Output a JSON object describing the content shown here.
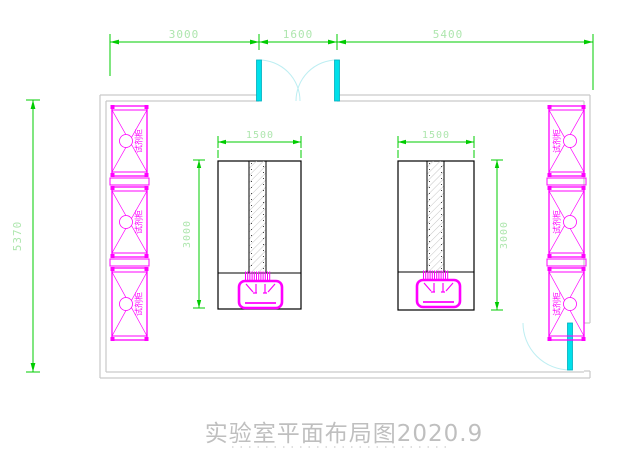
{
  "title": {
    "text": "实验室平面布局图2020.9"
  },
  "dims": {
    "top": [
      "3000",
      "1600",
      "5400"
    ],
    "room_height": "5370"
  },
  "benches": [
    {
      "width": "1500",
      "depth": "3000"
    },
    {
      "width": "1500",
      "depth": "3000"
    }
  ],
  "cabinets": {
    "label": "试剂柜",
    "left_count": 3,
    "right_count": 3
  },
  "colors": {
    "dimension_line": "#00cc00",
    "dimension_text": "#aee6ae",
    "cabinet": "#ff00ff",
    "door_leaf": "#00e0ea",
    "door_swing": "#bdeef2",
    "wall": "#c9c9c9",
    "bench_outline": "#000000",
    "title_text": "#bfbfbf"
  }
}
